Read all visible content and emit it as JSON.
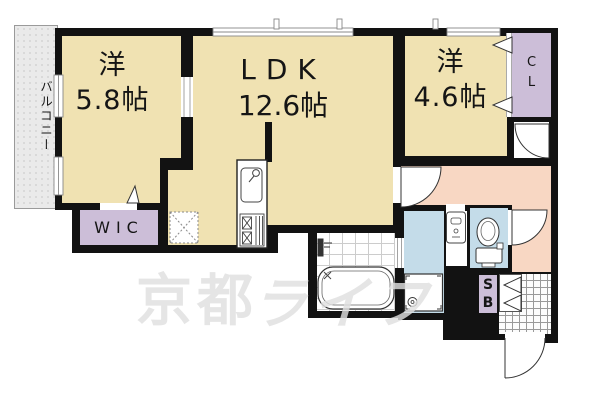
{
  "balcony": {
    "label": "バルコニー"
  },
  "rooms": {
    "west1": {
      "name": "洋",
      "size": "5.8帖"
    },
    "ldk": {
      "name": "LDK",
      "size": "12.6帖"
    },
    "west2": {
      "name": "洋",
      "size": "4.6帖"
    },
    "wic": {
      "label": "WIC"
    },
    "cl": {
      "line1": "C",
      "line2": "L"
    },
    "sb": {
      "line1": "S",
      "line2": "B"
    }
  },
  "watermark": {
    "text1": "京都",
    "text2": "ライフ"
  },
  "fixtures": [
    "kitchen-sink",
    "gas-stove",
    "refrigerator-space",
    "bathtub",
    "shower-fixture",
    "washing-machine-pan",
    "vanity-basin",
    "toilet",
    "entrance-door",
    "closet-doors",
    "shoe-box-doors"
  ],
  "colors": {
    "wall": "#121212",
    "cream": "#f0e2b2",
    "purple": "#ccbed8",
    "pink": "#f8d7c3",
    "blue": "#c4dce9",
    "balcony": "#eaeaea",
    "tile_line": "#999999",
    "watermark": "#e0e0e0"
  }
}
